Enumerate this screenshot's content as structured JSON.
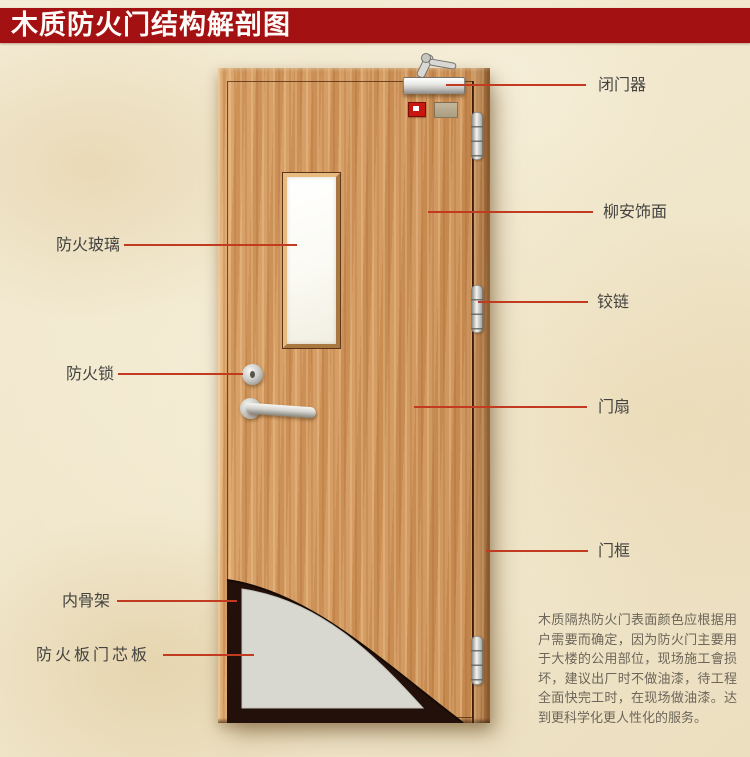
{
  "title": "木质防火门结构解剖图",
  "annotations": {
    "left": [
      {
        "label": "防火玻璃"
      },
      {
        "label": "防火锁"
      },
      {
        "label": "内骨架"
      },
      {
        "label": "防火板门芯板"
      }
    ],
    "right": [
      {
        "label": "闭门器"
      },
      {
        "label": "柳安饰面"
      },
      {
        "label": "铰链"
      },
      {
        "label": "门扇"
      },
      {
        "label": "门框"
      }
    ]
  },
  "note": "木质隔热防火门表面颜色应根据用户需要而确定，因为防火门主要用于大楼的公用部位，现场施工會损坏，建议出厂时不做油漆，待工程全面快完工时，在现场做油漆。达到更科学化更人性化的服务。",
  "colors": {
    "banner_red": "#a41113",
    "leader_line": "#c23b21",
    "wood": "#d19a62",
    "inner_skeleton_dark": "#24100a",
    "core_panel_gray": "#d8d7d0",
    "background_parchment": "#f2e9d0"
  }
}
